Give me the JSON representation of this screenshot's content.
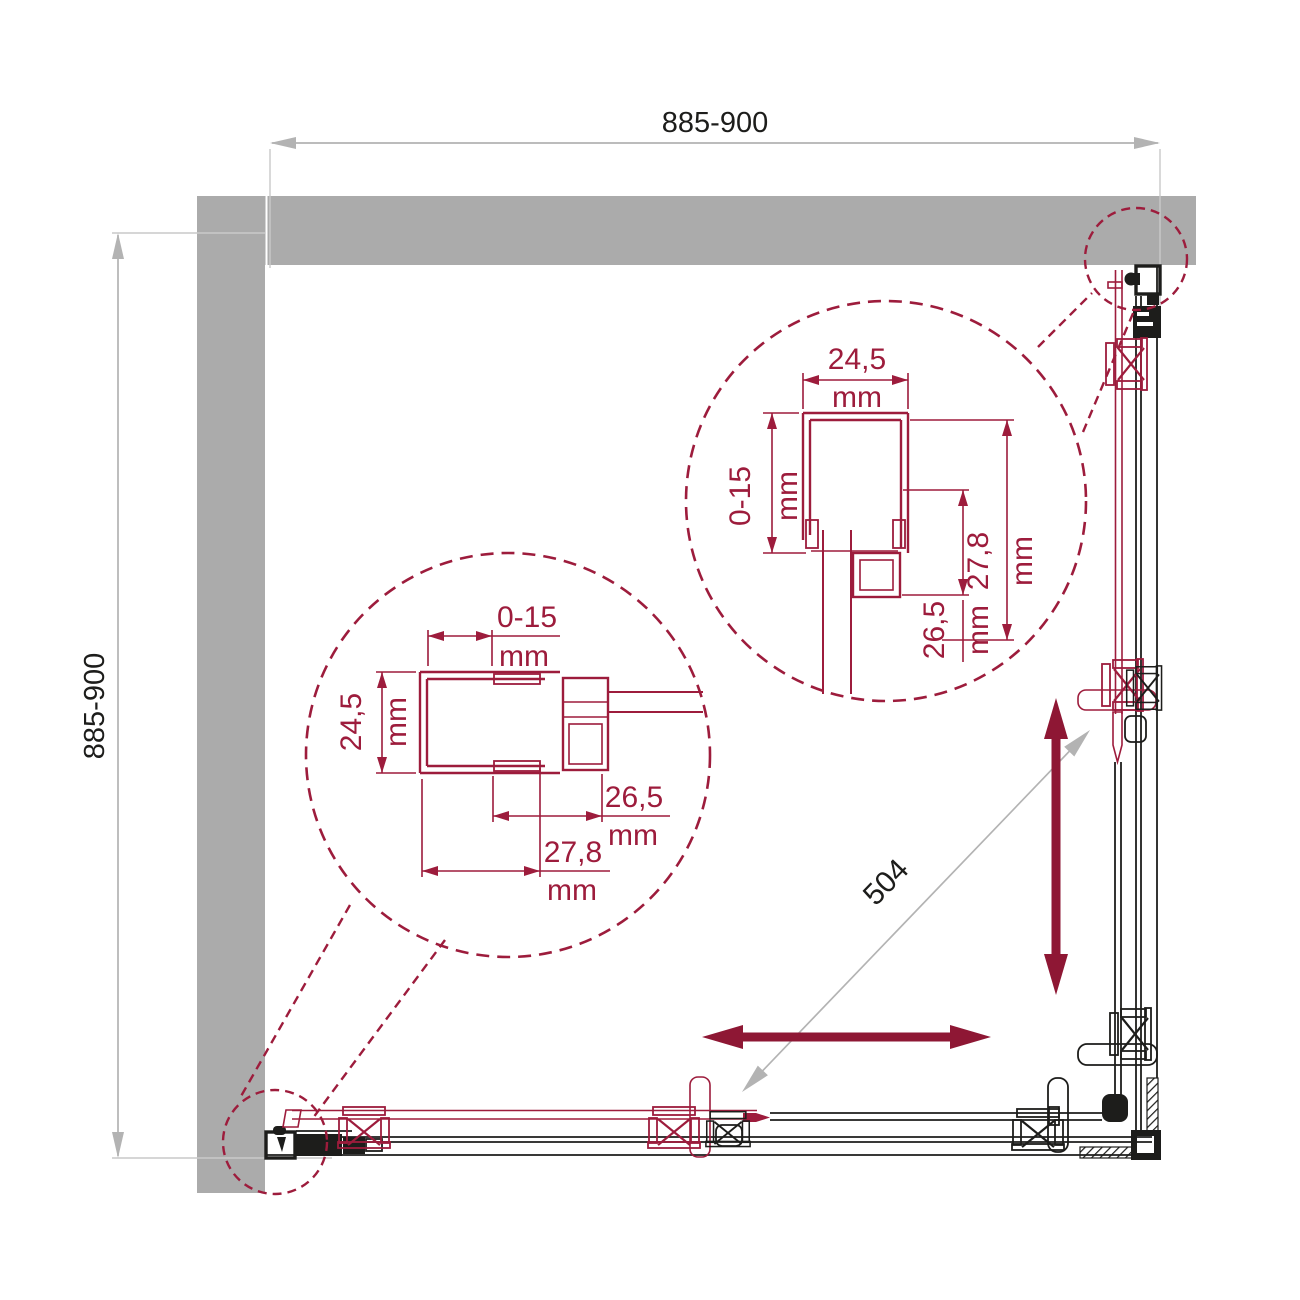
{
  "colors": {
    "red": "#9d1c3c",
    "arrow_red": "#8e1734",
    "wall_gray": "#ababab",
    "dim_gray": "#b3b3b3",
    "ext_gray": "#c9c9c9",
    "black": "#1d1d1b",
    "background": "#ffffff"
  },
  "dimensions": {
    "top_width": "885-900",
    "left_height": "885-900",
    "diagonal_opening": "504",
    "unit": "mm"
  },
  "detail_top_right": {
    "profile_width": "24,5",
    "adjustment_range": "0-15",
    "depth_inner": "26,5",
    "depth_outer": "27,8"
  },
  "detail_bottom_left": {
    "adjustment_range": "0-15",
    "profile_width": "24,5",
    "depth_inner": "26,5",
    "depth_outer": "27,8"
  }
}
